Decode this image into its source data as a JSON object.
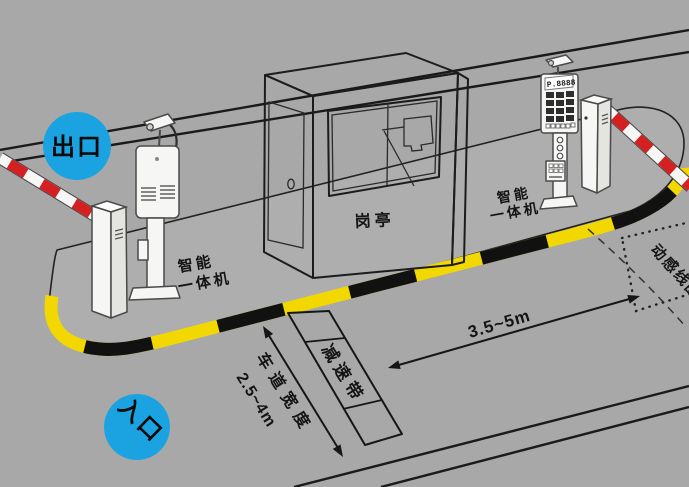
{
  "diagram": {
    "exit_badge": "出口",
    "entrance_badge": "入口",
    "booth_label": "岗亭",
    "machine_label_line1": "智能",
    "machine_label_line2": "一体机",
    "speed_bump_label": "减速带",
    "lane_width_label": "车道宽度",
    "lane_width_value": "2.5~4m",
    "distance_label": "3.5~5m",
    "induction_loop_label": "动感线圈",
    "entrance_machine_display": "P.8888"
  },
  "colors": {
    "road_gray": "#a8a8a8",
    "island_gray": "#aeaeae",
    "badge_blue": "#1ba3e1",
    "curb_yellow": "#f2d800",
    "curb_black": "#111111",
    "barrier_red": "#d42020",
    "barrier_white": "#f7f7f5",
    "line_black": "#1a1a1a"
  }
}
